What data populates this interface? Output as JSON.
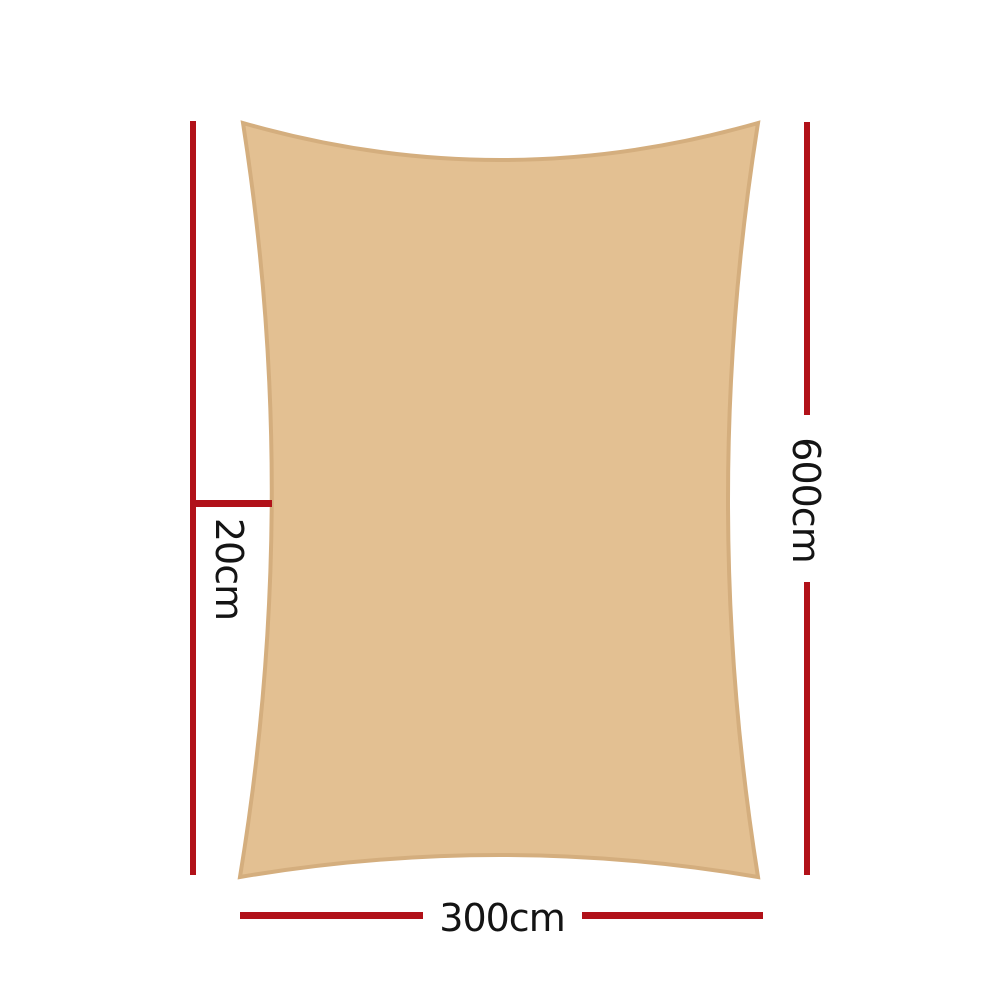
{
  "diagram": {
    "title": "shade-sail-dimension-diagram",
    "labels": {
      "height": "600cm",
      "width": "300cm",
      "offset": "20cm"
    },
    "colors": {
      "dimension_line": "#b11119",
      "sail_fill": "#e3c092",
      "sail_border": "#d4ae7e",
      "label_text": "#141414"
    }
  }
}
